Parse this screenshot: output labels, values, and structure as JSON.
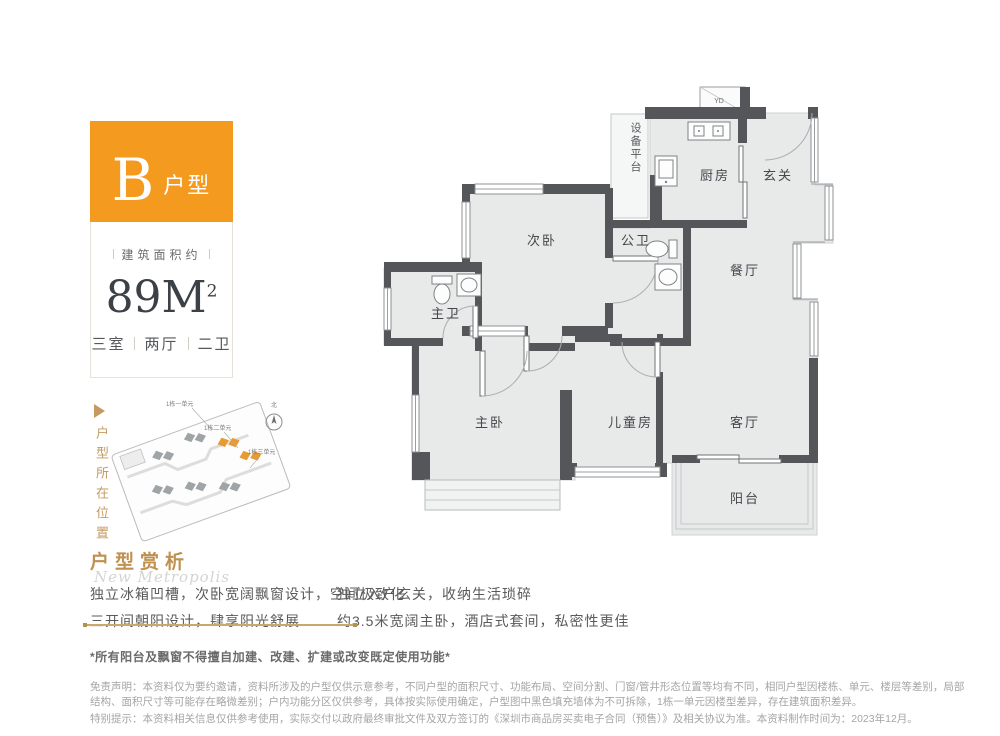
{
  "colors": {
    "accent_orange": "#f49a1e",
    "accent_gold": "#c49a62"
  },
  "unit_card": {
    "type_letter": "B",
    "type_word": "户型",
    "area_caption": "建筑面积约",
    "area_value": "89M",
    "area_sup": "2",
    "layout_parts": [
      "三室",
      "两厅",
      "二卫"
    ]
  },
  "location": {
    "vertical_label": "户型所在位置",
    "site_labels": [
      "1栋一单元",
      "1栋二单元",
      "1栋三单元"
    ],
    "compass_label": "北"
  },
  "floorplan": {
    "duct_label": "YD",
    "platform_label": "设备平台",
    "rooms": [
      {
        "label": "厨房"
      },
      {
        "label": "玄关"
      },
      {
        "label": "次卧"
      },
      {
        "label": "公卫"
      },
      {
        "label": "餐厅"
      },
      {
        "label": "主卫"
      },
      {
        "label": "主卧"
      },
      {
        "label": "儿童房"
      },
      {
        "label": "客厅"
      },
      {
        "label": "阳台"
      }
    ]
  },
  "analysis": {
    "title": "户型赏析",
    "watermark": "New Metropolis",
    "bullets": {
      "left": [
        "独立冰箱凹槽，次卧宽阔飘窗设计，空间极致化",
        "三开间朝阳设计，肆享阳光舒展"
      ],
      "right": [
        "独立入户玄关，收纳生活琐碎",
        "约3.5米宽阔主卧，酒店式套间，私密性更佳"
      ]
    }
  },
  "disclaimer": {
    "warning": "*所有阳台及飘窗不得擅自加建、改建、扩建或改变既定使用功能*",
    "notice": "免责声明：本资料仅为要约邀请，资料所涉及的户型仅供示意参考，不同户型的面积尺寸、功能布局、空间分割、门窗/管井形态位置等均有不同，相同户型因楼栋、单元、楼层等差别，局部结构、面积尺寸等可能存在略微差别；户内功能分区仅供参考，具体按实际使用确定，户型图中黑色填充墙体为不可拆除，1栋一单元因楼型差异，存在建筑面积差异。",
    "special": "特别提示：本资料相关信息仅供参考使用，实际交付以政府最终审批文件及双方签订的《深圳市商品房买卖电子合同（预售）》及相关协议为准。本资料制作时间为：2023年12月。"
  }
}
